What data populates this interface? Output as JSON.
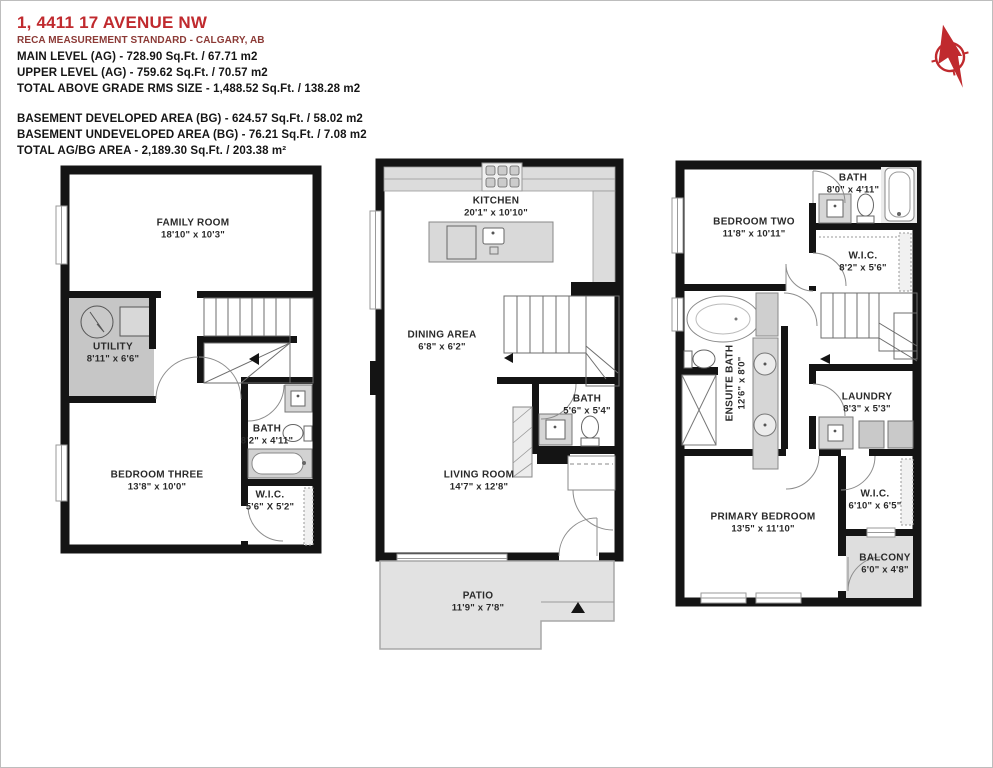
{
  "header": {
    "title": "1, 4411 17 AVENUE NW",
    "subtitle": "RECA MEASUREMENT STANDARD - CALGARY, AB",
    "above_grade": [
      "MAIN LEVEL (AG) - 728.90 Sq.Ft. / 67.71 m2",
      "UPPER LEVEL (AG) - 759.62 Sq.Ft. / 70.57 m2",
      "TOTAL ABOVE GRADE RMS SIZE - 1,488.52 Sq.Ft. / 138.28 m2"
    ],
    "below_grade": [
      "BASEMENT DEVELOPED AREA (BG) -  624.57 Sq.Ft. / 58.02 m2",
      "BASEMENT UNDEVELOPED AREA (BG) - 76.21 Sq.Ft. / 7.08 m2",
      "TOTAL AG/BG AREA -  2,189.30 Sq.Ft. /  203.38 m²"
    ]
  },
  "colors": {
    "accent_red": "#c02a2e",
    "wall_black": "#141414",
    "utility_gray": "#c6c6c6",
    "counter_gray": "#dcdcdc",
    "patio_gray": "#e2e2e2"
  },
  "basement": {
    "rooms": [
      {
        "name": "FAMILY ROOM",
        "dims": "18'10\" x 10'3\""
      },
      {
        "name": "UTILITY",
        "dims": "8'11\" x 6'6\""
      },
      {
        "name": "BEDROOM THREE",
        "dims": "13'8\" x 10'0\""
      },
      {
        "name": "BATH",
        "dims": "8'2\" x 4'11\""
      },
      {
        "name": "W.I.C.",
        "dims": "5'6\" X 5'2\""
      }
    ]
  },
  "main": {
    "rooms": [
      {
        "name": "KITCHEN",
        "dims": "20'1\" x 10'10\""
      },
      {
        "name": "DINING AREA",
        "dims": "6'8\" x 6'2\""
      },
      {
        "name": "BATH",
        "dims": "5'6\" x 5'4\""
      },
      {
        "name": "LIVING ROOM",
        "dims": "14'7\" x 12'8\""
      },
      {
        "name": "PATIO",
        "dims": "11'9\" x 7'8\""
      }
    ]
  },
  "upper": {
    "rooms": [
      {
        "name": "BEDROOM TWO",
        "dims": "11'8\" x 10'11\""
      },
      {
        "name": "BATH",
        "dims": "8'0\" x 4'11\""
      },
      {
        "name": "W.I.C.",
        "dims": "8'2\" x 5'6\""
      },
      {
        "name": "ENSUITE BATH",
        "dims": "12'6\" x 8'0\""
      },
      {
        "name": "LAUNDRY",
        "dims": "8'3\" x 5'3\""
      },
      {
        "name": "PRIMARY BEDROOM",
        "dims": "13'5\" x 11'10\""
      },
      {
        "name": "W.I.C.",
        "dims": "6'10\" x 6'5\""
      },
      {
        "name": "BALCONY",
        "dims": "6'0\" x 4'8\""
      }
    ]
  }
}
